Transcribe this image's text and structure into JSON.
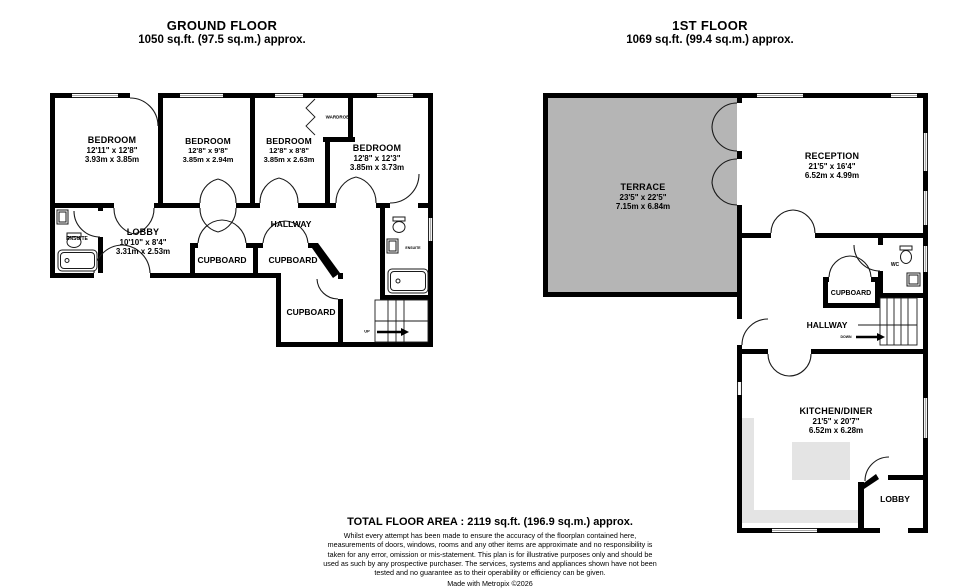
{
  "colors": {
    "wall": "#000000",
    "terrace_fill": "#b5b5b5",
    "counter_fill": "#e4e4e4"
  },
  "ground_floor": {
    "title": "GROUND FLOOR",
    "area": "1050 sq.ft. (97.5 sq.m.) approx.",
    "rooms": {
      "bedroom1": {
        "name": "BEDROOM",
        "dims_imperial": "12'11\" x 12'8\"",
        "dims_metric": "3.93m x 3.85m"
      },
      "bedroom2": {
        "name": "BEDROOM",
        "dims_imperial": "12'8\" x 9'8\"",
        "dims_metric": "3.85m x 2.94m"
      },
      "bedroom3": {
        "name": "BEDROOM",
        "dims_imperial": "12'8\" x 8'8\"",
        "dims_metric": "3.85m x 2.63m"
      },
      "bedroom4": {
        "name": "BEDROOM",
        "dims_imperial": "12'8\" x 12'3\"",
        "dims_metric": "3.85m x 3.73m"
      },
      "lobby": {
        "name": "LOBBY",
        "dims_imperial": "10'10\" x 8'4\"",
        "dims_metric": "3.31m x 2.53m"
      },
      "wardrobe": "WARDROBE",
      "ensuite_left": "ENSUITE",
      "ensuite_right": "ENSUITE",
      "hallway": "HALLWAY",
      "cupboard_1": "CUPBOARD",
      "cupboard_2": "CUPBOARD",
      "cupboard_3": "CUPBOARD",
      "stairs_label": "UP"
    }
  },
  "first_floor": {
    "title": "1ST FLOOR",
    "area": "1069 sq.ft. (99.4 sq.m.) approx.",
    "rooms": {
      "terrace": {
        "name": "TERRACE",
        "dims_imperial": "23'5\" x 22'5\"",
        "dims_metric": "7.15m x 6.84m"
      },
      "reception": {
        "name": "RECEPTION",
        "dims_imperial": "21'5\" x 16'4\"",
        "dims_metric": "6.52m x 4.99m"
      },
      "kitchen_diner": {
        "name": "KITCHEN/DINER",
        "dims_imperial": "21'5\" x 20'7\"",
        "dims_metric": "6.52m x 6.28m"
      },
      "wc": "WC",
      "cupboard": "CUPBOARD",
      "hallway": "HALLWAY",
      "lobby": "LOBBY",
      "stairs_label": "DOWN"
    }
  },
  "footer": {
    "total_area": "TOTAL FLOOR AREA : 2119 sq.ft. (196.9 sq.m.) approx.",
    "disclaimer": "Whilst every attempt has been made to ensure the accuracy of the floorplan contained here, measurements of doors, windows, rooms and any other items are approximate and no responsibility is taken for any error, omission or mis-statement. This plan is for illustrative purposes only and should be used as such by any prospective purchaser. The services, systems and appliances shown have not been tested and no guarantee as to their operability or efficiency can be given.",
    "credit": "Made with Metropix ©2026"
  }
}
